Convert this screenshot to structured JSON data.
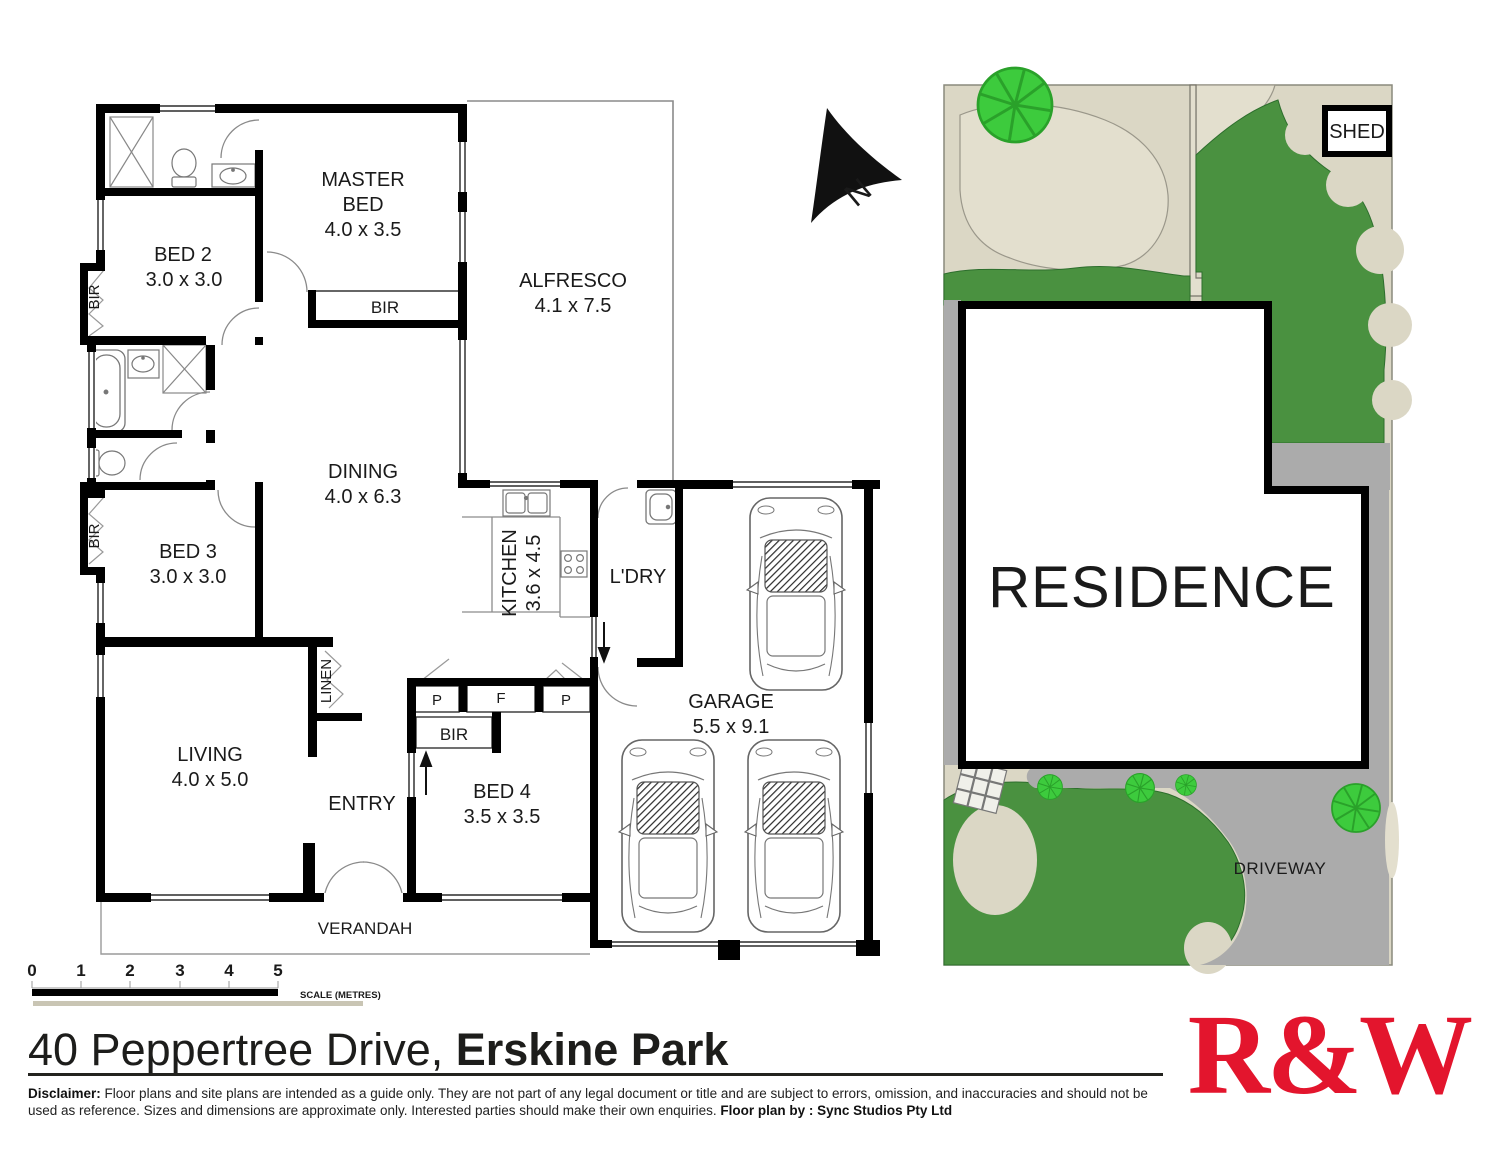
{
  "floor_plan": {
    "rooms": {
      "master_bed": {
        "line1": "MASTER",
        "line2": "BED",
        "dims": "4.0 x 3.5"
      },
      "bed2": {
        "name": "BED 2",
        "dims": "3.0 x 3.0"
      },
      "bed3": {
        "name": "BED 3",
        "dims": "3.0 x 3.0"
      },
      "bed4": {
        "name": "BED 4",
        "dims": "3.5 x 3.5"
      },
      "living": {
        "name": "LIVING",
        "dims": "4.0 x 5.0"
      },
      "dining": {
        "name": "DINING",
        "dims": "4.0 x 6.3"
      },
      "kitchen": {
        "name": "KITCHEN",
        "dims": "3.6 x 4.5"
      },
      "alfresco": {
        "name": "ALFRESCO",
        "dims": "4.1 x 7.5"
      },
      "garage": {
        "name": "GARAGE",
        "dims": "5.5 x 9.1"
      },
      "laundry": {
        "name": "L'DRY"
      },
      "entry": {
        "name": "ENTRY"
      },
      "verandah": {
        "name": "VERANDAH"
      },
      "linen": {
        "name": "LINEN"
      }
    },
    "closets": {
      "bir": "BIR",
      "pantry": "P",
      "fridge": "F"
    },
    "north_label": "N",
    "wall_color": "#000000"
  },
  "site_plan": {
    "residence": "RESIDENCE",
    "shed": "SHED",
    "driveway": "DRIVEWAY",
    "colors": {
      "grass": "#4A9140",
      "ground": "#DBD7C5",
      "path_blob": "#E3DFCE",
      "driveway": "#ABABAB",
      "tree": "#3DCB3D",
      "tree_line": "#2AA12A"
    }
  },
  "scale_bar": {
    "ticks": [
      "0",
      "1",
      "2",
      "3",
      "4",
      "5"
    ],
    "caption": "SCALE (METRES)"
  },
  "footer": {
    "address_regular": "40 Peppertree Drive, ",
    "address_bold": "Erskine Park",
    "disclaimer_bold": "Disclaimer:",
    "disclaimer_text": " Floor plans and site plans are intended as a guide only. They are not part of any legal document or title and are subject to errors, omission, and inaccuracies and should not be used as reference. Sizes and dimensions are approximate only. Interested parties should make their own enquiries. ",
    "floorplan_by_bold": "Floor plan by : Sync Studios Pty Ltd",
    "logo_text": "R&W",
    "logo_color": "#E3152D"
  }
}
